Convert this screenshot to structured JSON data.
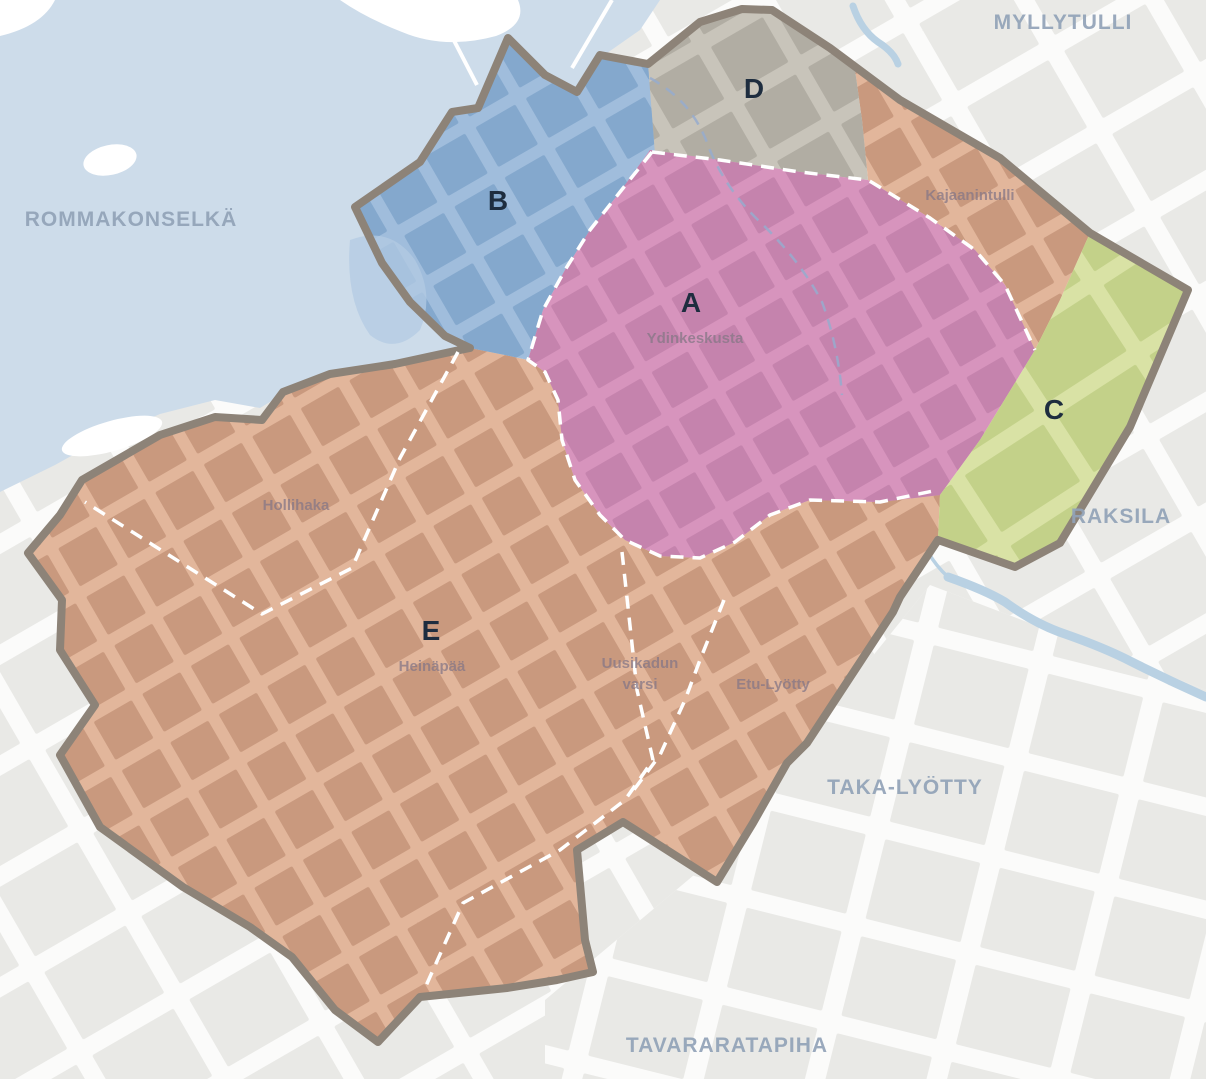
{
  "region_labels": {
    "myllytulli": "MYLLYTULLI",
    "rommakonselka": "ROMMAKONSELKÄ",
    "raksila": "RAKSILA",
    "taka_lyotty": "TAKA-LYÖTTY",
    "tavararatapiha": "TAVARARATAPIHA"
  },
  "zones": {
    "A": {
      "letter": "A",
      "district": "Ydinkeskusta",
      "street_color": "#d794bd",
      "block_color": "#c583ad"
    },
    "B": {
      "letter": "B",
      "street_color": "#a0bddc",
      "block_color": "#84a8cd"
    },
    "C": {
      "letter": "C",
      "street_color": "#d9e2a5",
      "block_color": "#c3d189"
    },
    "D": {
      "letter": "D",
      "street_color": "#c8c4ba",
      "block_color": "#b1ada3"
    },
    "E": {
      "letter": "E",
      "street_color": "#e2b69b",
      "block_color": "#c9997e",
      "districts": {
        "hollihaka": "Hollihaka",
        "heinapaa": "Heinäpää",
        "uusikadun_line1": "Uusikadun",
        "uusikadun_line2": "varsi",
        "etu_lyotty": "Etu-Lyötty",
        "kajaanintulli": "Kajaanintulli"
      }
    }
  },
  "colors": {
    "water": "#cddcea",
    "background": "#fbfbfa",
    "outside_block": "#e9e9e6",
    "island": "#ffffff",
    "zone_border": "#8d8378",
    "inner_boundary_dash": "#ffffff",
    "stream": "#b9d1e3",
    "stream_dash": "#96abce",
    "pond_in_b": "#b3cbe3",
    "region_label_text": "#92a3b8",
    "district_label_text": "#857786",
    "zone_letter_text": "#1e2d3f"
  }
}
